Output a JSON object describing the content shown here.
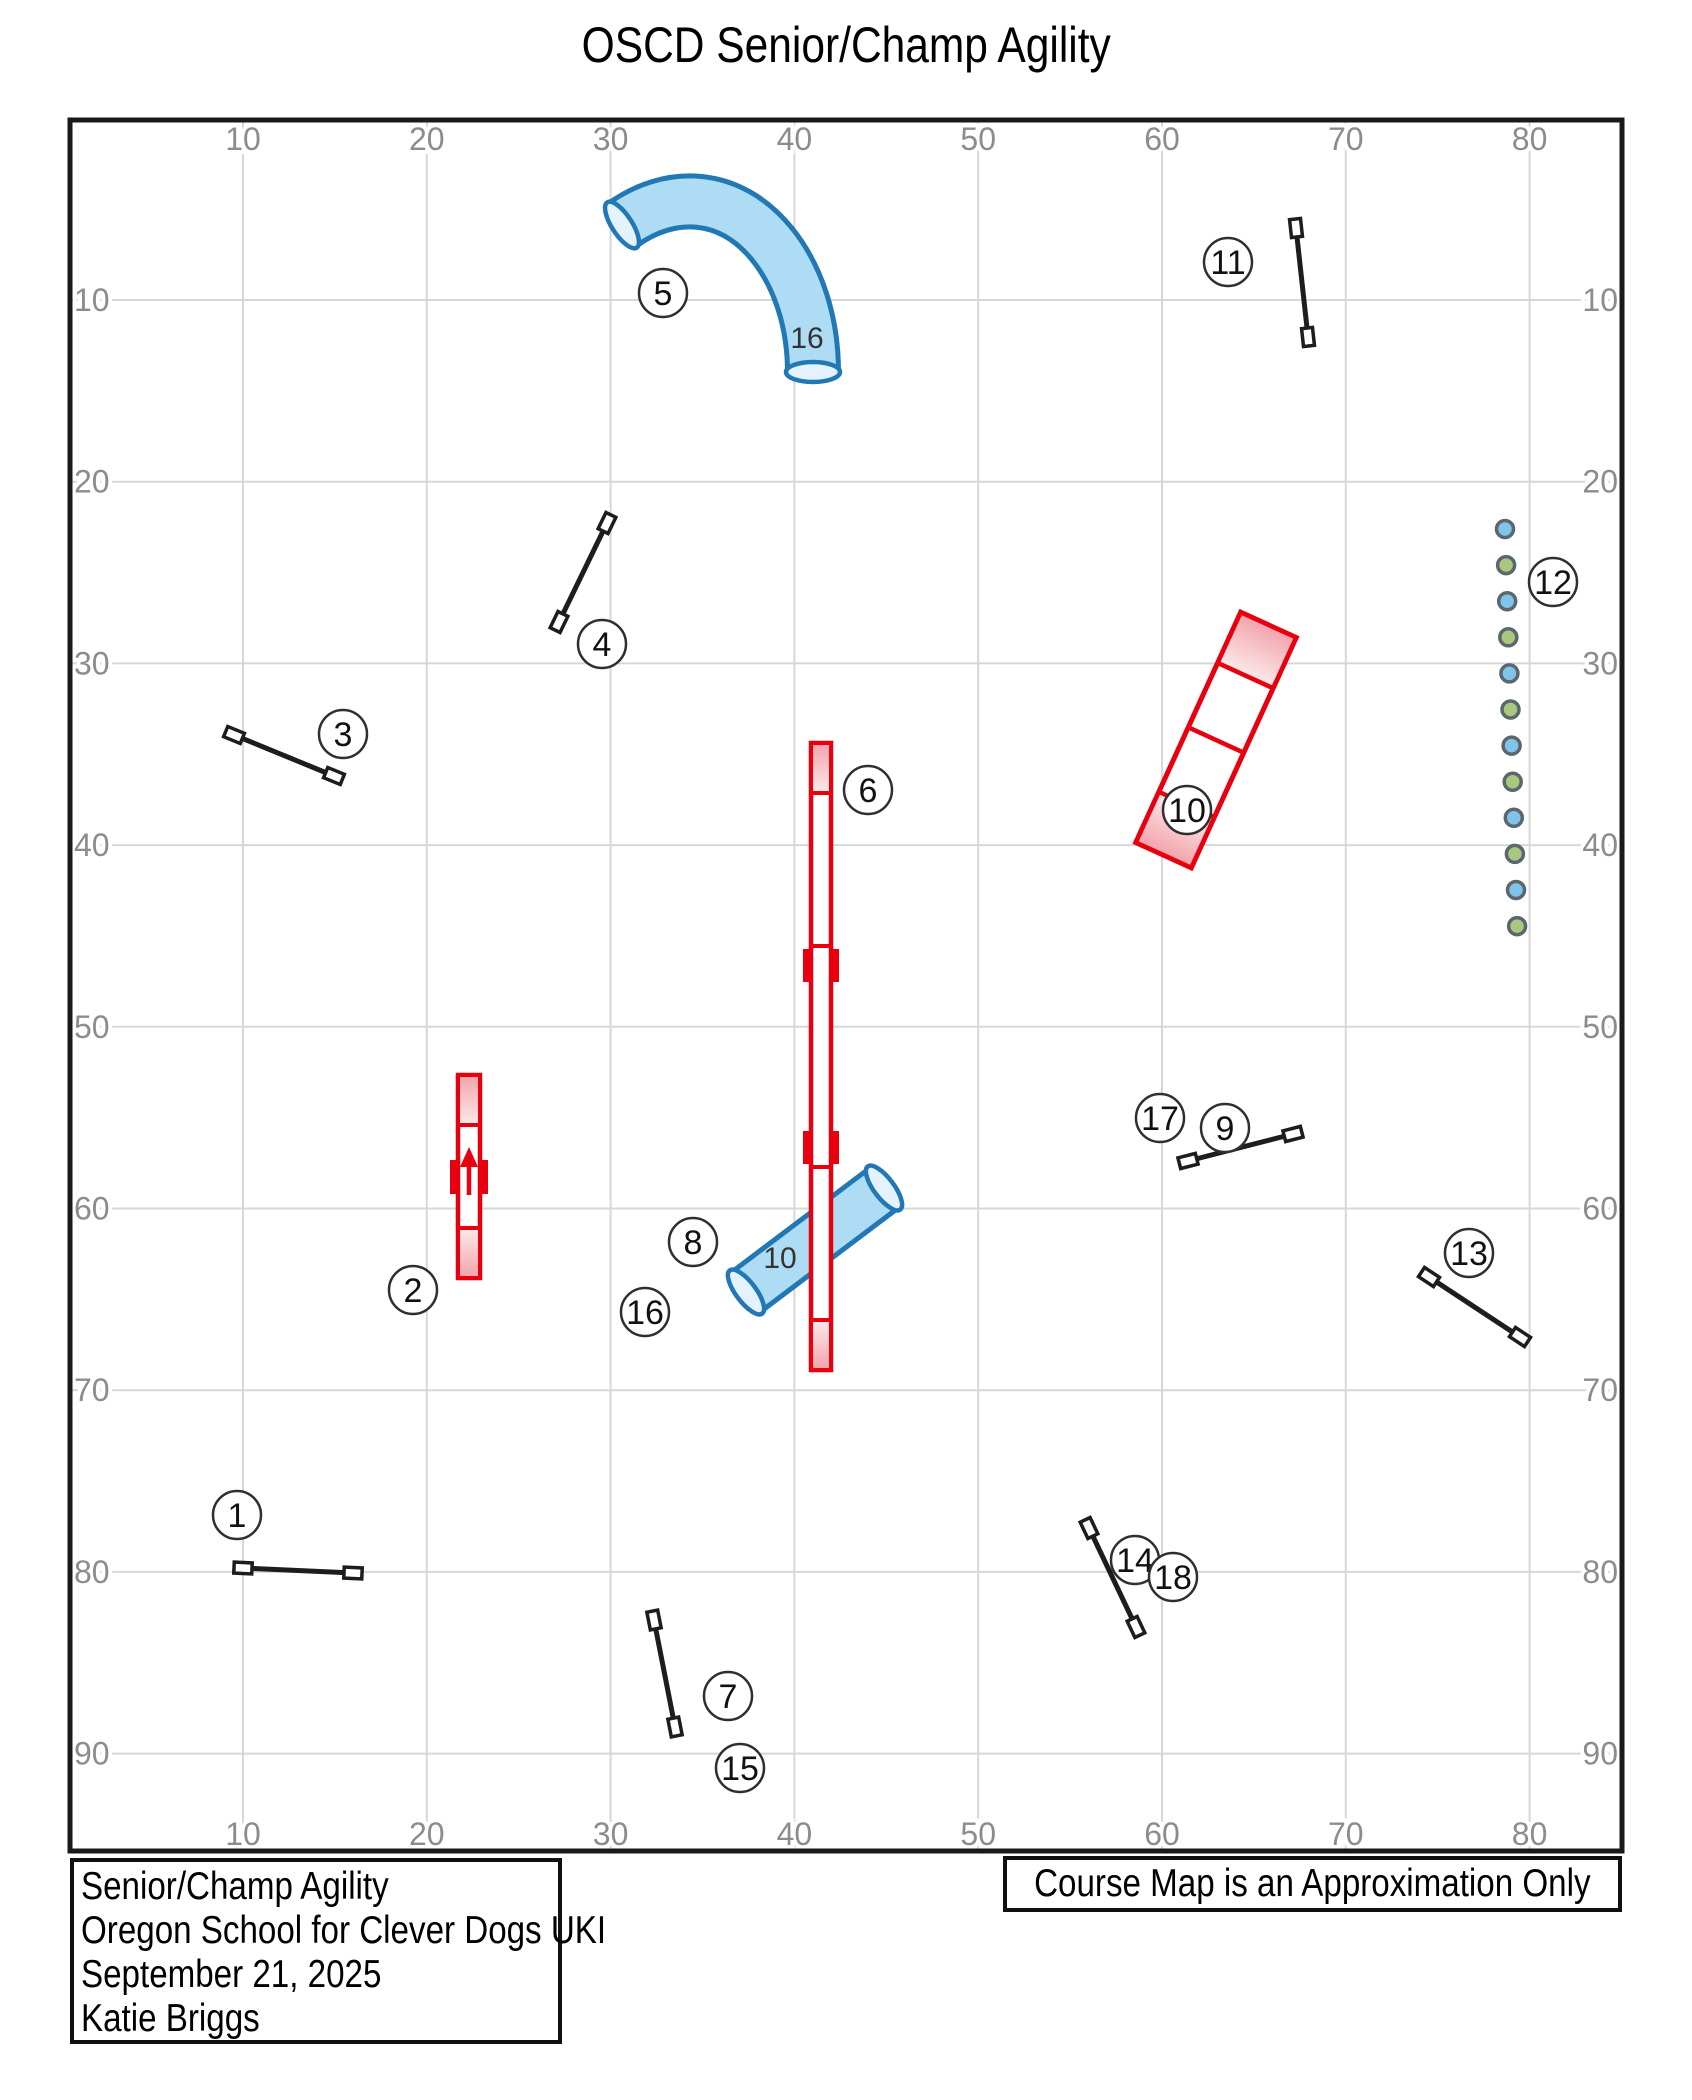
{
  "title": "OSCD Senior/Champ Agility",
  "info_box": {
    "lines": [
      "Senior/Champ Agility",
      "Oregon School for Clever Dogs UKI",
      "September 21, 2025",
      "Katie Briggs"
    ]
  },
  "disclaimer_box": {
    "text": "Course Map is an Approximation Only"
  },
  "axes": {
    "x_ticks": [
      "10",
      "20",
      "30",
      "40",
      "50",
      "60",
      "70",
      "80"
    ],
    "y_ticks": [
      "10",
      "20",
      "30",
      "40",
      "50",
      "60",
      "70",
      "80",
      "90"
    ]
  },
  "colors": {
    "grid": "#d7d7d7",
    "frame": "#1a1a1a",
    "tick_label": "#8c8c8c",
    "obstacle_red": "#e8000f",
    "contact_pink_dark": "#f2a3ab",
    "contact_pink_light": "#fce9ea",
    "tunnel_fill": "#aedcf5",
    "tunnel_outline": "#2178b5",
    "tunnel_opening": "#e3f2fc",
    "jump_bar": "#1d1d1d",
    "weave_blue": "#7fc4ea",
    "weave_green": "#a9c87e",
    "weave_ring": "#5c666d",
    "marker_stroke": "#2f2f2f",
    "marker_text": "#111111",
    "length_label": "#333333"
  },
  "markers": [
    {
      "label": "1",
      "x": 237,
      "y": 1515
    },
    {
      "label": "2",
      "x": 413,
      "y": 1290
    },
    {
      "label": "3",
      "x": 343,
      "y": 734
    },
    {
      "label": "4",
      "x": 602,
      "y": 644
    },
    {
      "label": "5",
      "x": 663,
      "y": 293
    },
    {
      "label": "6",
      "x": 868,
      "y": 790
    },
    {
      "label": "7",
      "x": 728,
      "y": 1696
    },
    {
      "label": "8",
      "x": 693,
      "y": 1242
    },
    {
      "label": "9",
      "x": 1225,
      "y": 1128
    },
    {
      "label": "10",
      "x": 1187,
      "y": 810
    },
    {
      "label": "11",
      "x": 1228,
      "y": 262
    },
    {
      "label": "12",
      "x": 1553,
      "y": 582
    },
    {
      "label": "13",
      "x": 1469,
      "y": 1253
    },
    {
      "label": "14",
      "x": 1135,
      "y": 1560
    },
    {
      "label": "15",
      "x": 740,
      "y": 1768
    },
    {
      "label": "16",
      "x": 645,
      "y": 1312
    },
    {
      "label": "17",
      "x": 1160,
      "y": 1118
    },
    {
      "label": "18",
      "x": 1173,
      "y": 1577
    }
  ],
  "tunnel_length_labels": [
    {
      "text": "16",
      "x": 807,
      "y": 348
    },
    {
      "text": "10",
      "x": 780,
      "y": 1268
    }
  ],
  "course": {
    "jumps": [
      {
        "name": "jump-1",
        "x1": 243,
        "y1": 1568,
        "x2": 353,
        "y2": 1573
      },
      {
        "name": "jump-3",
        "x1": 234,
        "y1": 735,
        "x2": 334,
        "y2": 776
      },
      {
        "name": "jump-4",
        "x1": 607,
        "y1": 523,
        "x2": 559,
        "y2": 622
      },
      {
        "name": "jump-7-15",
        "x1": 654,
        "y1": 1620,
        "x2": 675,
        "y2": 1727
      },
      {
        "name": "jump-9-17",
        "x1": 1188,
        "y1": 1161,
        "x2": 1293,
        "y2": 1134
      },
      {
        "name": "jump-11",
        "x1": 1296,
        "y1": 228,
        "x2": 1308,
        "y2": 337
      },
      {
        "name": "jump-13",
        "x1": 1429,
        "y1": 1277,
        "x2": 1520,
        "y2": 1337
      },
      {
        "name": "jump-14-18",
        "x1": 1089,
        "y1": 1528,
        "x2": 1136,
        "y2": 1627
      }
    ],
    "teeter": {
      "cx": 469,
      "w": 22,
      "top": 1075,
      "bottom": 1278,
      "contact": 50,
      "pivot": 1177
    },
    "dogwalk": {
      "cx": 821,
      "w": 20,
      "top": 743,
      "bottom": 1370,
      "contact": 50,
      "joints": [
        {
          "y": 946,
          "ticks": "below"
        },
        {
          "y": 1167,
          "ticks": "above"
        }
      ]
    },
    "aframe": {
      "cx": 1216,
      "cy": 740,
      "len": 253,
      "w": 61,
      "angle": 24.5,
      "contact_frac": 0.22
    },
    "weaves": {
      "x": 1505,
      "y": 529,
      "dx": 1.1,
      "dy": 36.1,
      "count": 12,
      "r": 8.5
    },
    "tunnel_curved": {
      "path": "M 622 225 C 670 190 730 192 772 244 C 798 276 813 322 813 372",
      "outline_w": 56,
      "fill_w": 46,
      "openings": [
        {
          "x": 622,
          "y": 225,
          "angle": -33
        },
        {
          "x": 813,
          "y": 372,
          "angle": 90
        }
      ]
    },
    "tunnel_straight": {
      "x1": 746,
      "y1": 1292,
      "x2": 884,
      "y2": 1188,
      "outline_w": 54,
      "fill_w": 44
    }
  }
}
